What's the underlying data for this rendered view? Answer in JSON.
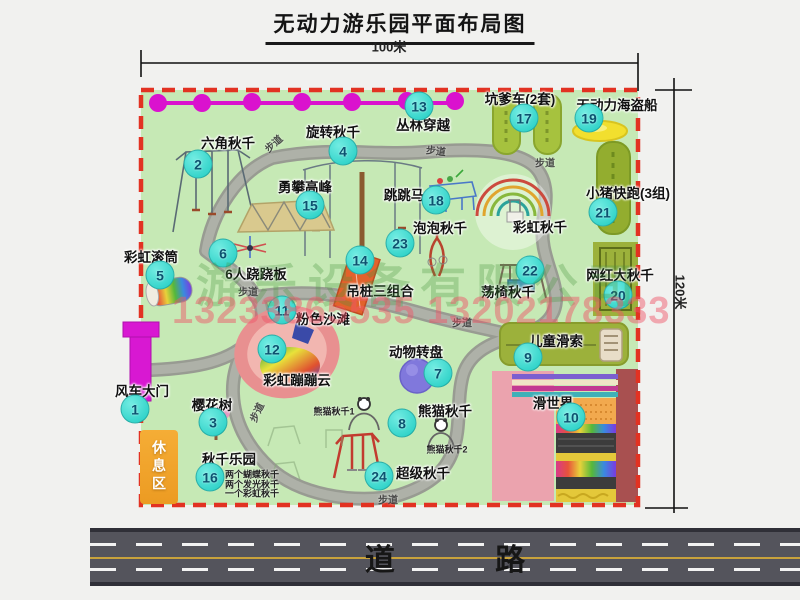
{
  "title": "无动力游乐园平面布局图",
  "dimensions": {
    "width": "100米",
    "height": "120米"
  },
  "road": {
    "label": "道 路"
  },
  "rest_area": {
    "label": "休息区"
  },
  "watermark": {
    "company": "游乐设备有限公司",
    "phone": "13233865535 13202178333"
  },
  "swing_park_notes": [
    "两个蝴蝶秋千",
    "两个发光秋千",
    "一个彩虹秋千"
  ],
  "attractions": [
    {
      "num": "1",
      "label": "风车大门",
      "mx": 135,
      "my": 409,
      "lx": 142,
      "ly": 390
    },
    {
      "num": "2",
      "label": "六角秋千",
      "mx": 198,
      "my": 164,
      "lx": 228,
      "ly": 142
    },
    {
      "num": "3",
      "label": "樱花树",
      "mx": 213,
      "my": 422,
      "lx": 212,
      "ly": 404
    },
    {
      "num": "4",
      "label": "旋转秋千",
      "mx": 343,
      "my": 151,
      "lx": 333,
      "ly": 131
    },
    {
      "num": "5",
      "label": "彩虹滚筒",
      "mx": 160,
      "my": 275,
      "lx": 151,
      "ly": 256
    },
    {
      "num": "6",
      "label": "6人跷跷板",
      "mx": 223,
      "my": 253,
      "lx": 256,
      "ly": 273
    },
    {
      "num": "7",
      "label": "动物转盘",
      "mx": 438,
      "my": 373,
      "lx": 416,
      "ly": 351
    },
    {
      "num": "8",
      "label": "熊猫秋千",
      "mx": 402,
      "my": 423,
      "lx": 445,
      "ly": 410
    },
    {
      "num": "9",
      "label": "儿童滑索",
      "mx": 528,
      "my": 357,
      "lx": 556,
      "ly": 340
    },
    {
      "num": "10",
      "label": "滑世界",
      "mx": 571,
      "my": 417,
      "lx": 553,
      "ly": 402
    },
    {
      "num": "11",
      "label": "粉色沙滩",
      "mx": 282,
      "my": 310,
      "lx": 323,
      "ly": 318
    },
    {
      "num": "12",
      "label": "彩虹蹦蹦云",
      "mx": 272,
      "my": 349,
      "lx": 297,
      "ly": 379
    },
    {
      "num": "13",
      "label": "丛林穿越",
      "mx": 419,
      "my": 106,
      "lx": 423,
      "ly": 124
    },
    {
      "num": "14",
      "label": "吊桩三组合",
      "mx": 360,
      "my": 260,
      "lx": 380,
      "ly": 290
    },
    {
      "num": "15",
      "label": "勇攀高峰",
      "mx": 310,
      "my": 205,
      "lx": 305,
      "ly": 186
    },
    {
      "num": "16",
      "label": "秋千乐园",
      "mx": 210,
      "my": 477,
      "lx": 229,
      "ly": 458
    },
    {
      "num": "17",
      "label": "坑爹车(2套)",
      "mx": 524,
      "my": 118,
      "lx": 520,
      "ly": 98
    },
    {
      "num": "18",
      "label": "跳跳马",
      "mx": 436,
      "my": 200,
      "lx": 404,
      "ly": 194
    },
    {
      "num": "19",
      "label": "无动力海盗船",
      "mx": 589,
      "my": 118,
      "lx": 617,
      "ly": 104
    },
    {
      "num": "20",
      "label": "网红大秋千",
      "mx": 618,
      "my": 295,
      "lx": 620,
      "ly": 274
    },
    {
      "num": "21",
      "label": "小猪快跑(3组)",
      "mx": 603,
      "my": 212,
      "lx": 628,
      "ly": 192
    },
    {
      "num": "22",
      "label": "荡椅秋千",
      "mx": 530,
      "my": 270,
      "lx": 508,
      "ly": 291
    },
    {
      "num": "23",
      "label": "泡泡秋千",
      "mx": 400,
      "my": 243,
      "lx": 440,
      "ly": 227
    },
    {
      "num": "24",
      "label": "超级秋千",
      "mx": 379,
      "my": 476,
      "lx": 423,
      "ly": 472
    }
  ],
  "extra_labels": [
    {
      "text": "彩虹秋千",
      "x": 540,
      "y": 226,
      "size": 13.5
    },
    {
      "text": "熊猫秋千1",
      "x": 334,
      "y": 411,
      "size": 9
    },
    {
      "text": "熊猫秋千2",
      "x": 447,
      "y": 449,
      "size": 9
    }
  ],
  "path_labels": [
    {
      "text": "步道",
      "x": 273,
      "y": 143,
      "r": -42
    },
    {
      "text": "步道",
      "x": 436,
      "y": 150,
      "r": 6
    },
    {
      "text": "步道",
      "x": 545,
      "y": 162,
      "r": 0
    },
    {
      "text": "步道",
      "x": 248,
      "y": 291,
      "r": 0
    },
    {
      "text": "步道",
      "x": 462,
      "y": 322,
      "r": 0
    },
    {
      "text": "步道",
      "x": 256,
      "y": 412,
      "r": -65
    },
    {
      "text": "步道",
      "x": 388,
      "y": 499,
      "r": 0
    }
  ],
  "colors": {
    "map_green": "#c6e9b5",
    "border_red": "#e23222",
    "path_gray": "#a7aaa3",
    "marker_cyan": "#2fd8cc",
    "magenta": "#da12ce",
    "road_gray": "#54545c"
  }
}
